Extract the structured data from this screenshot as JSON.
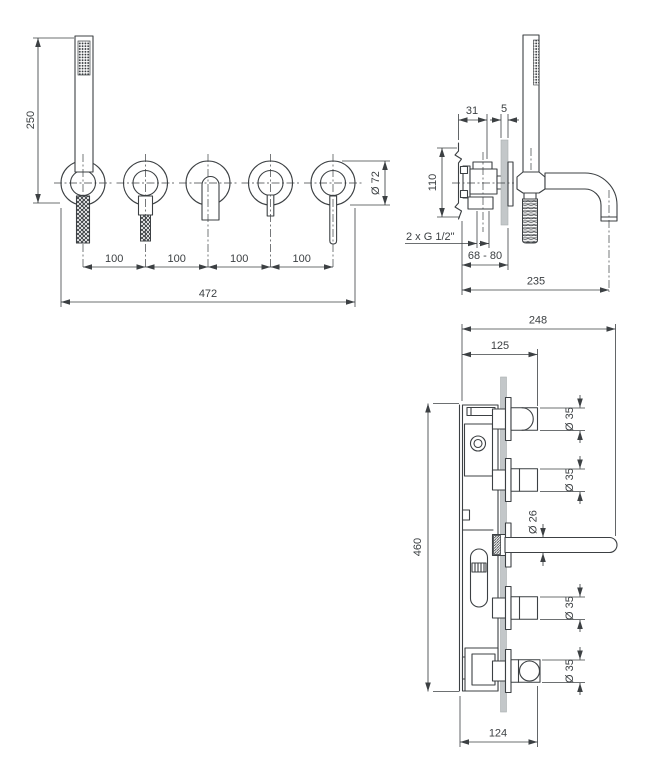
{
  "colors": {
    "line": "#3c4043",
    "text": "#3c4043",
    "wall_plate": "#c3c7c9",
    "background": "#ffffff"
  },
  "front_view": {
    "height_dim": "250",
    "spacing_dims": [
      "100",
      "100",
      "100",
      "100"
    ],
    "total_width_dim": "472",
    "escutcheon_diameter_dim": "Ø 72"
  },
  "side_view": {
    "rough_in_depth_dim": "31",
    "plate_thickness_dim": "5",
    "rough_in_height_dim": "110",
    "connection_label": "2 x G 1/2\"",
    "mounting_depth_dim": "68 - 80",
    "spout_reach_dim": "235"
  },
  "section_view": {
    "overall_depth_dim": "248",
    "handle_projection_dim": "125",
    "rough_in_length_dim": "460",
    "holder_projection_dim": "124",
    "handle_diameter_dims": [
      "Ø 35",
      "Ø 35",
      "Ø 35",
      "Ø 35"
    ],
    "spout_diameter_dim": "Ø 26"
  }
}
